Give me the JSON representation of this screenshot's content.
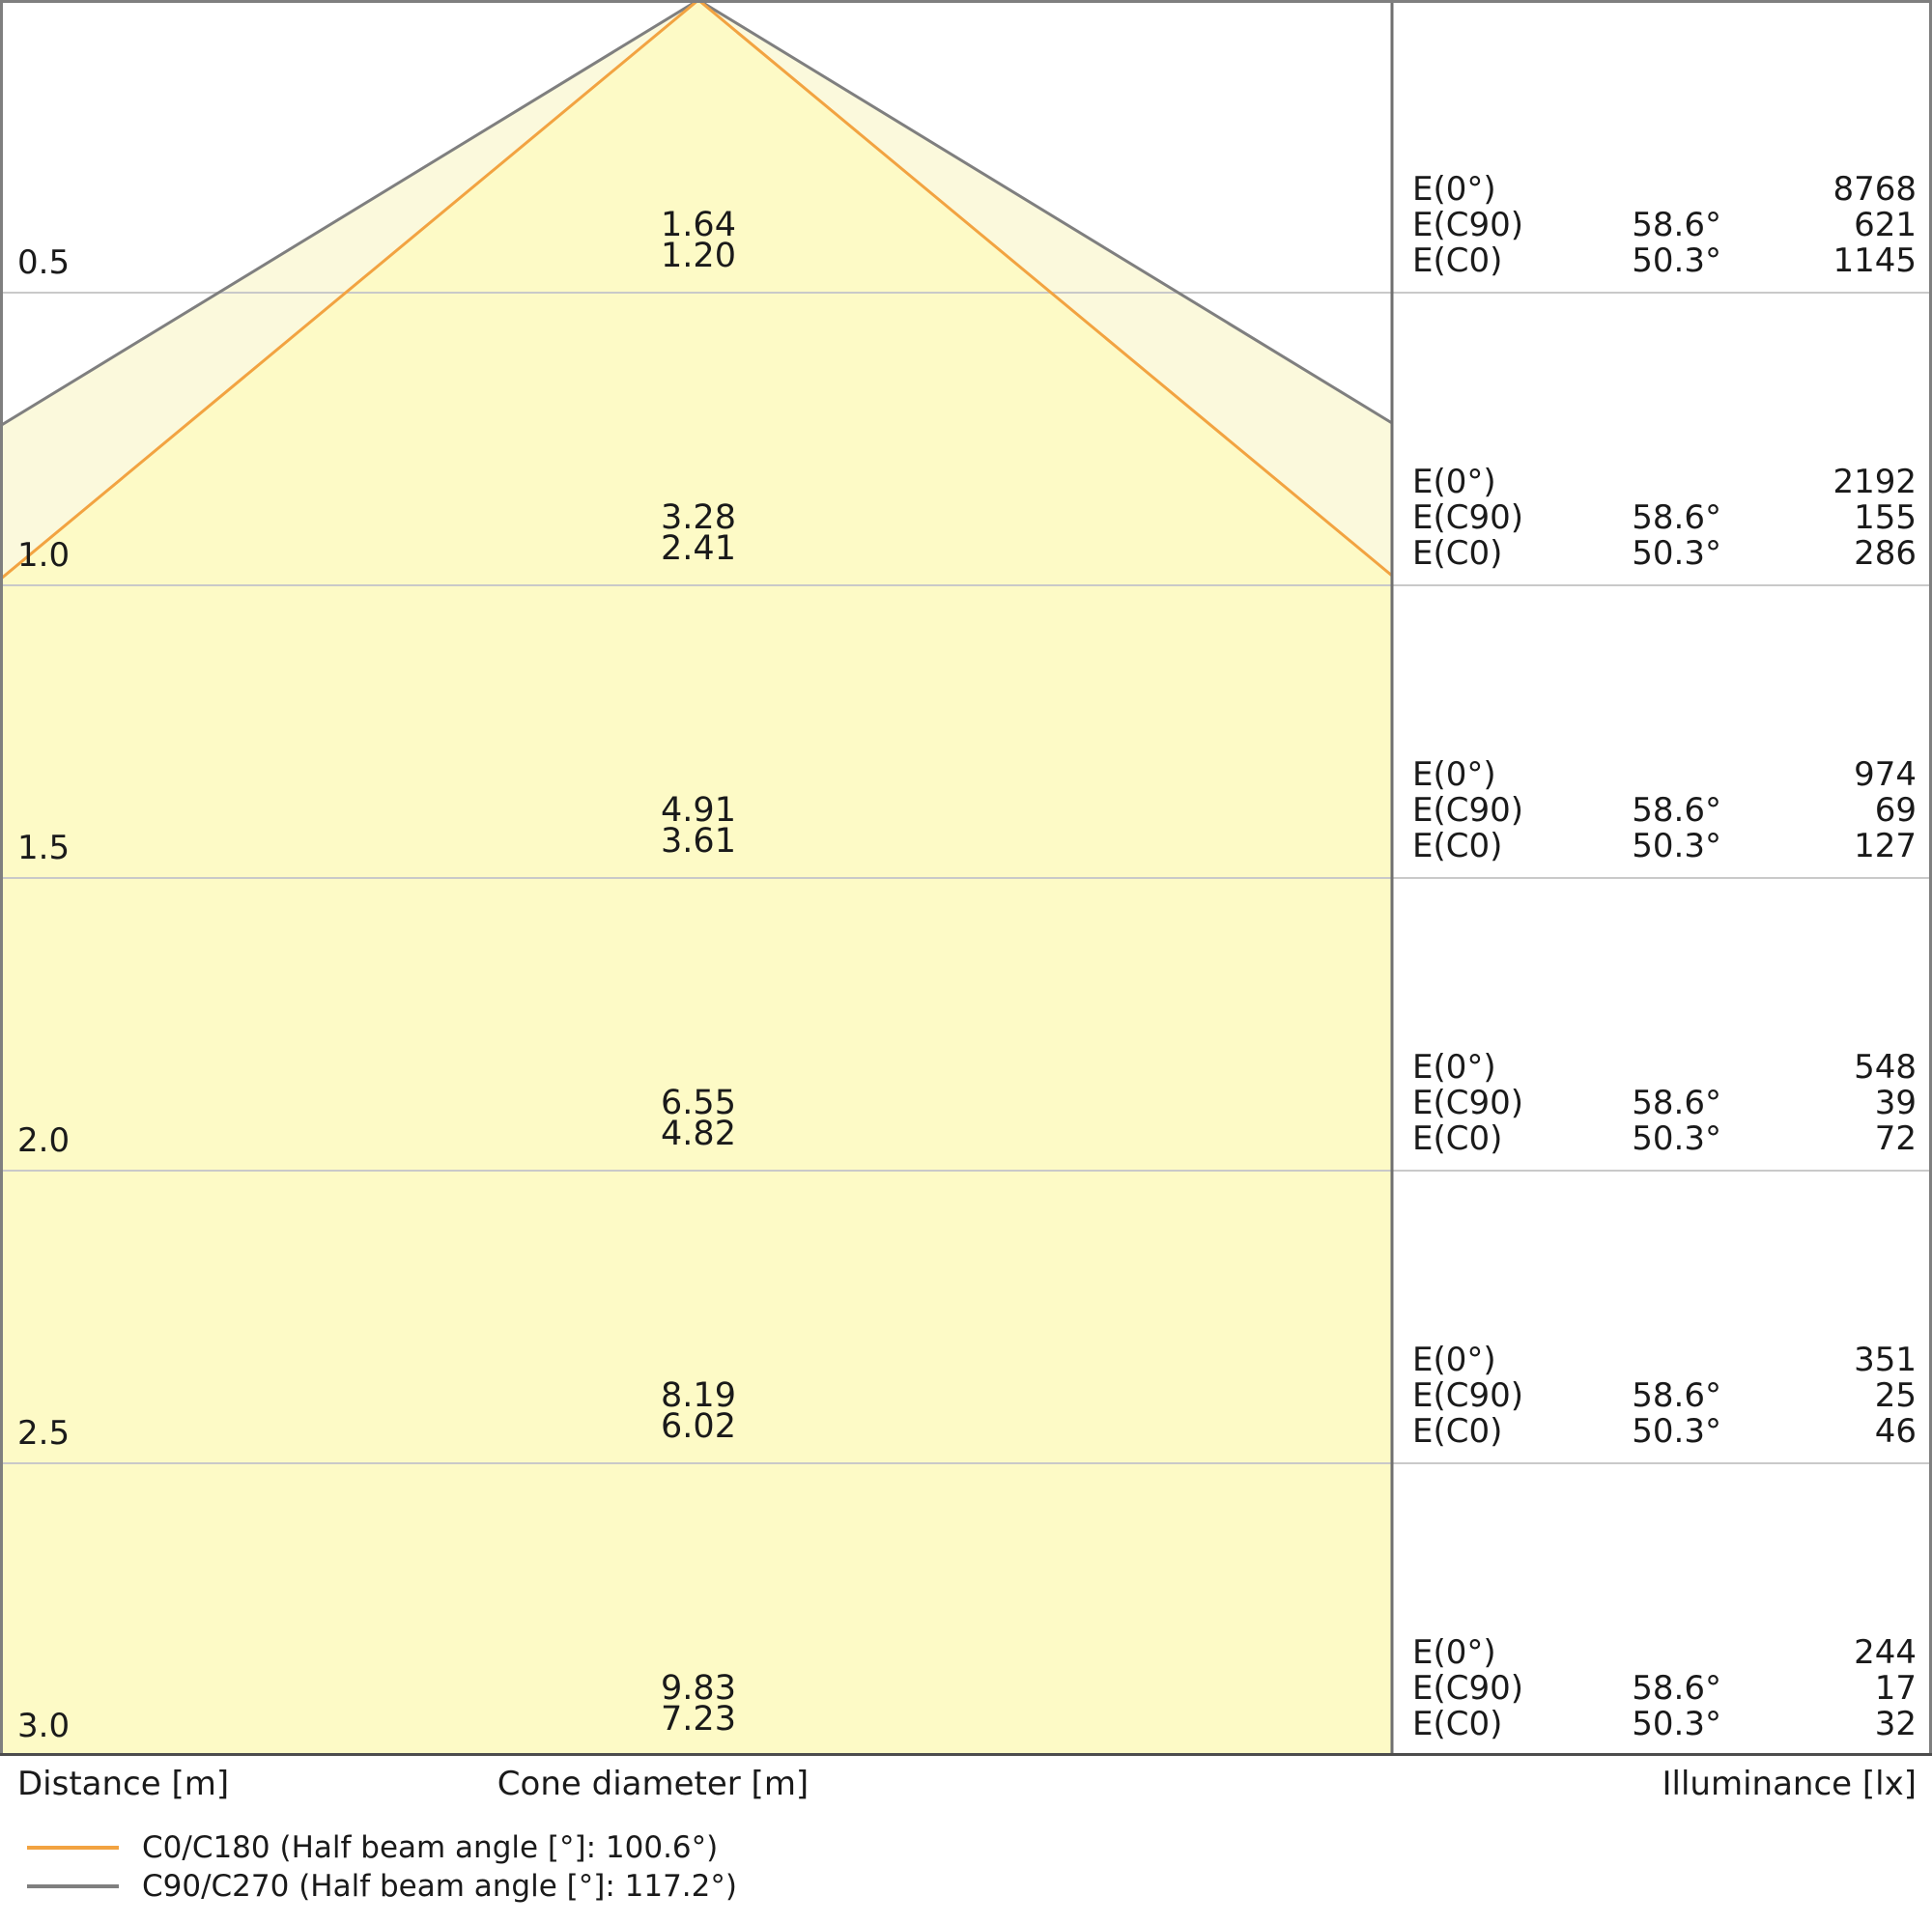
{
  "chart_data": {
    "type": "cone-diagram",
    "title": "Light distribution cone diagram",
    "axis_labels": {
      "distance": "Distance [m]",
      "cone_diameter": "Cone diameter [m]",
      "illuminance": "Illuminance [lx]"
    },
    "legend": [
      {
        "series": "C0/C180",
        "half_beam_angle": "100.6°",
        "label": "C0/C180 (Half beam angle [°]: 100.6°)",
        "color": "#F2A341"
      },
      {
        "series": "C90/C270",
        "half_beam_angle": "117.2°",
        "label": "C90/C270 (Half beam angle [°]: 117.2°)",
        "color": "#7F7F7F"
      }
    ],
    "colors": {
      "fill_inner": "#FDFAC6",
      "fill_outer": "#FBF9DC",
      "c0_line": "#F2A341",
      "c90_line": "#7F7F7F",
      "gridline": "#C9C9C9",
      "border": "#7F7F7F"
    },
    "rows": [
      {
        "distance": "0.5",
        "cone_diameter_c90": "1.64",
        "cone_diameter_c0": "1.20",
        "illuminance": [
          {
            "label": "E(0°)",
            "angle": "",
            "value": "8768"
          },
          {
            "label": "E(C90)",
            "angle": "58.6°",
            "value": "621"
          },
          {
            "label": "E(C0)",
            "angle": "50.3°",
            "value": "1145"
          }
        ]
      },
      {
        "distance": "1.0",
        "cone_diameter_c90": "3.28",
        "cone_diameter_c0": "2.41",
        "illuminance": [
          {
            "label": "E(0°)",
            "angle": "",
            "value": "2192"
          },
          {
            "label": "E(C90)",
            "angle": "58.6°",
            "value": "155"
          },
          {
            "label": "E(C0)",
            "angle": "50.3°",
            "value": "286"
          }
        ]
      },
      {
        "distance": "1.5",
        "cone_diameter_c90": "4.91",
        "cone_diameter_c0": "3.61",
        "illuminance": [
          {
            "label": "E(0°)",
            "angle": "",
            "value": "974"
          },
          {
            "label": "E(C90)",
            "angle": "58.6°",
            "value": "69"
          },
          {
            "label": "E(C0)",
            "angle": "50.3°",
            "value": "127"
          }
        ]
      },
      {
        "distance": "2.0",
        "cone_diameter_c90": "6.55",
        "cone_diameter_c0": "4.82",
        "illuminance": [
          {
            "label": "E(0°)",
            "angle": "",
            "value": "548"
          },
          {
            "label": "E(C90)",
            "angle": "58.6°",
            "value": "39"
          },
          {
            "label": "E(C0)",
            "angle": "50.3°",
            "value": "72"
          }
        ]
      },
      {
        "distance": "2.5",
        "cone_diameter_c90": "8.19",
        "cone_diameter_c0": "6.02",
        "illuminance": [
          {
            "label": "E(0°)",
            "angle": "",
            "value": "351"
          },
          {
            "label": "E(C90)",
            "angle": "58.6°",
            "value": "25"
          },
          {
            "label": "E(C0)",
            "angle": "50.3°",
            "value": "46"
          }
        ]
      },
      {
        "distance": "3.0",
        "cone_diameter_c90": "9.83",
        "cone_diameter_c0": "7.23",
        "illuminance": [
          {
            "label": "E(0°)",
            "angle": "",
            "value": "244"
          },
          {
            "label": "E(C90)",
            "angle": "58.6°",
            "value": "17"
          },
          {
            "label": "E(C0)",
            "angle": "50.3°",
            "value": "32"
          }
        ]
      }
    ]
  }
}
